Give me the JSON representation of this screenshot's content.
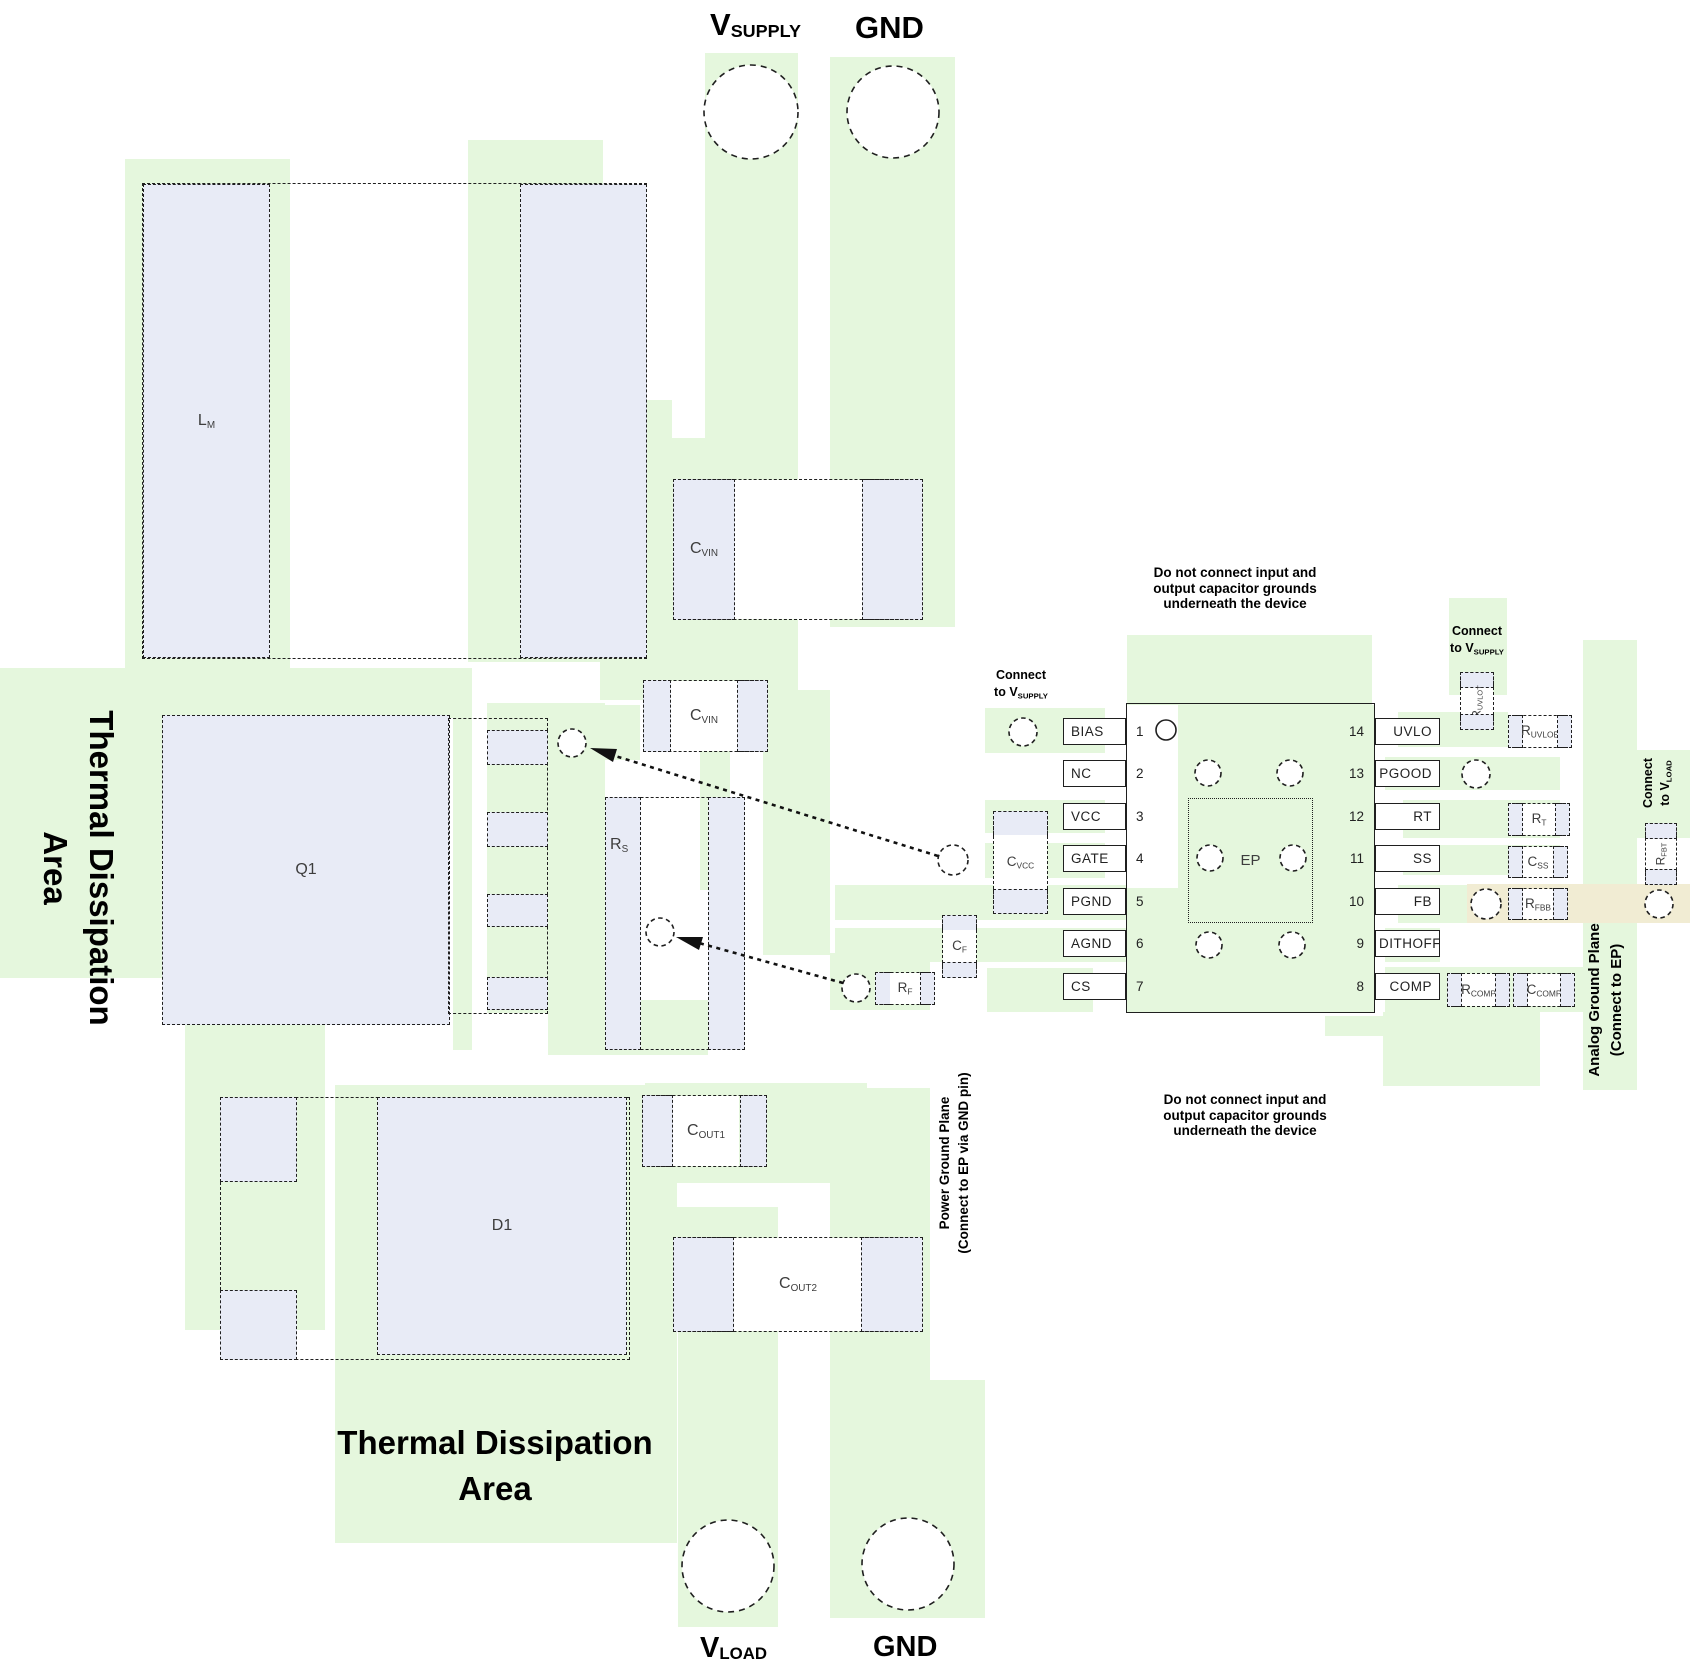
{
  "diagram_title": "PCB layout example (boost controller)",
  "colors": {
    "plane_green": "#e5f7dd",
    "pad_fill": "#e8ebf6",
    "highlight_tan": "#f1ecd3"
  },
  "ports": {
    "vsupply": {
      "m": "V",
      "s": "SUPPLY"
    },
    "gnd_top": "GND",
    "vload": {
      "m": "V",
      "s": "LOAD"
    },
    "gnd_bottom": "GND"
  },
  "labels": {
    "lm": {
      "m": "L",
      "s": "M"
    },
    "q1": "Q1",
    "d1": "D1",
    "rs": {
      "m": "R",
      "s": "S"
    },
    "cvin": {
      "m": "C",
      "s": "VIN"
    },
    "cvcc": {
      "m": "C",
      "s": "VCC"
    },
    "cf": {
      "m": "C",
      "s": "F"
    },
    "rf": {
      "m": "R",
      "s": "F"
    },
    "cout1": {
      "m": "C",
      "s": "OUT1"
    },
    "cout2": {
      "m": "C",
      "s": "OUT2"
    },
    "ruvlot": {
      "m": "R",
      "s": "UVLOT"
    },
    "ruvlob": {
      "m": "R",
      "s": "UVLOB"
    },
    "rt": {
      "m": "R",
      "s": "T"
    },
    "css": {
      "m": "C",
      "s": "SS"
    },
    "rfbb": {
      "m": "R",
      "s": "FBB"
    },
    "rfbt": {
      "m": "R",
      "s": "FBT"
    },
    "rcomp": {
      "m": "R",
      "s": "COMP"
    },
    "ccomp": {
      "m": "C",
      "s": "COMP"
    }
  },
  "ic": {
    "ep": "EP",
    "left_pins": [
      {
        "num": "1",
        "label": "BIAS"
      },
      {
        "num": "2",
        "label": "NC"
      },
      {
        "num": "3",
        "label": "VCC"
      },
      {
        "num": "4",
        "label": "GATE"
      },
      {
        "num": "5",
        "label": "PGND"
      },
      {
        "num": "6",
        "label": "AGND"
      },
      {
        "num": "7",
        "label": "CS"
      }
    ],
    "right_pins": [
      {
        "num": "14",
        "label": "UVLO"
      },
      {
        "num": "13",
        "label": "PGOOD"
      },
      {
        "num": "12",
        "label": "RT"
      },
      {
        "num": "11",
        "label": "SS"
      },
      {
        "num": "10",
        "label": "FB"
      },
      {
        "num": "9",
        "label": "DITHOFF"
      },
      {
        "num": "8",
        "label": "COMP"
      }
    ]
  },
  "notes": {
    "top": "Do not connect input and\noutput capacitor grounds\nunderneath the device",
    "bottom": "Do not connect input and\noutput capacitor grounds\nunderneath the device",
    "connect_vsupply": {
      "line1": "Connect",
      "line2_m": "to V",
      "line2_s": "SUPPLY"
    },
    "connect_vload": {
      "line1": "Connect",
      "line2_m": "to V",
      "line2_s": "LOAD"
    },
    "analog_gp": {
      "line1": "Analog Ground Plane",
      "line2": "(Connect to EP)"
    },
    "power_gp": {
      "line1": "Power Ground Plane",
      "line2": "(Connect to EP via GND pin)"
    },
    "thermal": {
      "line1": "Thermal Dissipation",
      "line2": "Area"
    }
  }
}
